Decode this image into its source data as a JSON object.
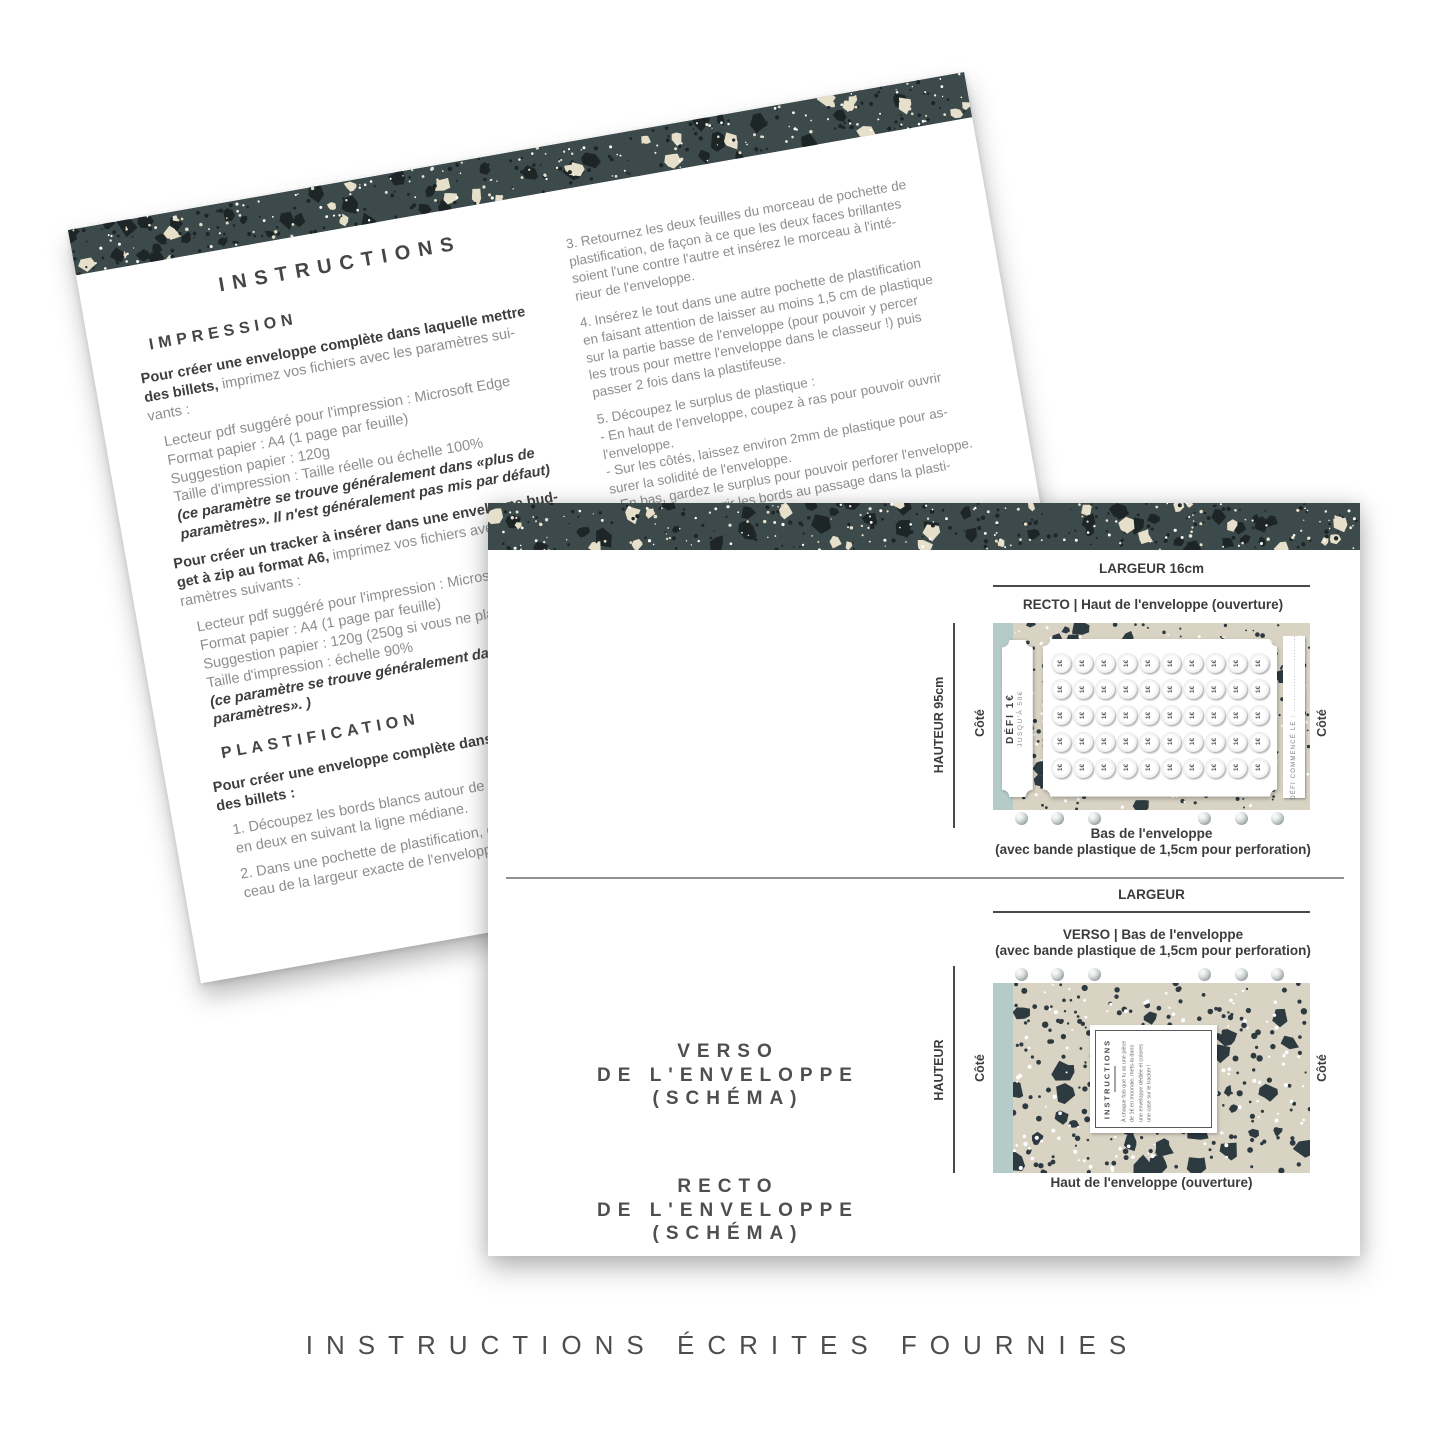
{
  "caption": "INSTRUCTIONS ÉCRITES FOURNIES",
  "colors": {
    "band_dark": "#3d4a4b",
    "band_chip_dark": "#1d2527",
    "band_chip_cream": "#e6dfca",
    "envelope_beige": "#d9d3c4",
    "envelope_chip": "#2d3a40",
    "sage_strip": "#b5cbc7",
    "text_dark": "#3e3e3e",
    "text_gray": "#8d8d8d"
  },
  "back_page": {
    "title": "INSTRUCTIONS",
    "left_column": [
      {
        "h": "IMPRESSION"
      },
      {
        "gap": 10
      },
      {
        "t": [
          [
            "b",
            "Pour créer une enveloppe complète dans laquelle mettre"
          ]
        ]
      },
      {
        "t": [
          [
            "b",
            "des billets, "
          ],
          [
            "r",
            "imprimez vos fichiers avec les paramètres sui-"
          ]
        ]
      },
      {
        "t": [
          [
            "r",
            "vants :"
          ]
        ]
      },
      {
        "gap": 9
      },
      {
        "t": [
          [
            "r",
            "Lecteur pdf suggéré pour l'impression : Microsoft Edge"
          ]
        ],
        "ind": 1
      },
      {
        "t": [
          [
            "r",
            "Format papier : A4 (1 page par feuille)"
          ]
        ],
        "ind": 1
      },
      {
        "t": [
          [
            "r",
            "Suggestion papier : 120g"
          ]
        ],
        "ind": 1
      },
      {
        "t": [
          [
            "r",
            "Taille d'impression : Taille réelle ou échelle 100%"
          ]
        ],
        "ind": 1
      },
      {
        "t": [
          [
            "bi",
            "(ce paramètre se trouve généralement dans «plus de"
          ]
        ],
        "ind": 1
      },
      {
        "t": [
          [
            "bi",
            "paramètres». Il n'est généralement pas mis par défaut)"
          ]
        ],
        "ind": 1
      },
      {
        "gap": 9
      },
      {
        "t": [
          [
            "b",
            "Pour créer un tracker à insérer dans une enveloppe bud-"
          ]
        ]
      },
      {
        "t": [
          [
            "b",
            "get à zip au format A6, "
          ],
          [
            "r",
            "imprimez vos fichiers avec les pa-"
          ]
        ]
      },
      {
        "t": [
          [
            "r",
            "ramètres suivants :"
          ]
        ]
      },
      {
        "gap": 9
      },
      {
        "t": [
          [
            "r",
            "Lecteur pdf suggéré pour l'impression : Microsoft Edge"
          ]
        ],
        "ind": 1
      },
      {
        "t": [
          [
            "r",
            "Format papier : A4 (1 page par feuille)"
          ]
        ],
        "ind": 1
      },
      {
        "t": [
          [
            "r",
            "Suggestion papier : 120g (250g si vous ne plastifiez pas)"
          ]
        ],
        "ind": 1
      },
      {
        "t": [
          [
            "r",
            "Taille d'impression : échelle 90%"
          ]
        ],
        "ind": 1
      },
      {
        "t": [
          [
            "bi",
            "(ce paramètre se trouve généralement dans «plus de"
          ]
        ],
        "ind": 1
      },
      {
        "t": [
          [
            "bi",
            "paramètres». )"
          ]
        ],
        "ind": 1
      },
      {
        "gap": 12
      },
      {
        "h": "PLASTIFICATION"
      },
      {
        "gap": 10
      },
      {
        "t": [
          [
            "b",
            "Pour créer une enveloppe complète dans laquelle mettre"
          ]
        ]
      },
      {
        "t": [
          [
            "b",
            "des billets :"
          ]
        ]
      },
      {
        "gap": 7
      },
      {
        "t": [
          [
            "r",
            "1. Découpez les bords blancs autour de vos feuilles et pliez"
          ]
        ],
        "ind": 1
      },
      {
        "t": [
          [
            "r",
            "en deux en suivant la ligne médiane."
          ]
        ],
        "ind": 1
      },
      {
        "gap": 7
      },
      {
        "t": [
          [
            "r",
            "2. Dans une pochette de plastification, découpez un mor-"
          ]
        ],
        "ind": 1
      },
      {
        "t": [
          [
            "r",
            "ceau de la largeur exacte de l'enveloppe."
          ]
        ],
        "ind": 1
      }
    ],
    "right_column": [
      {
        "t": [
          [
            "r",
            "3. Retournez les deux feuilles du morceau de pochette de"
          ]
        ]
      },
      {
        "t": [
          [
            "r",
            "plastification, de façon à ce que les deux faces brillantes"
          ]
        ]
      },
      {
        "t": [
          [
            "r",
            "soient l'une contre l'autre et insérez le morceau à l'inté-"
          ]
        ]
      },
      {
        "t": [
          [
            "r",
            "rieur de l'enveloppe."
          ]
        ]
      },
      {
        "gap": 10
      },
      {
        "t": [
          [
            "r",
            "4. Insérez le tout dans une autre pochette de plastification"
          ]
        ]
      },
      {
        "t": [
          [
            "r",
            "en faisant attention de laisser au moins 1,5 cm de plastique"
          ]
        ]
      },
      {
        "t": [
          [
            "r",
            "sur la partie basse de l'enveloppe (pour pouvoir y percer"
          ]
        ]
      },
      {
        "t": [
          [
            "r",
            "les trous pour mettre l'enveloppe dans le classeur !) puis"
          ]
        ]
      },
      {
        "t": [
          [
            "r",
            "passer 2 fois dans la plastifeuse."
          ]
        ]
      },
      {
        "gap": 10
      },
      {
        "t": [
          [
            "r",
            "5. Découpez le surplus de plastique :"
          ]
        ]
      },
      {
        "t": [
          [
            "r",
            "- En haut de l'enveloppe, coupez à ras pour pouvoir ouvrir"
          ]
        ]
      },
      {
        "t": [
          [
            "r",
            "l'enveloppe."
          ]
        ]
      },
      {
        "t": [
          [
            "r",
            "- Sur les côtés, laissez environ 2mm de plastique pour as-"
          ]
        ]
      },
      {
        "t": [
          [
            "r",
            "surer la solidité de l'enveloppe."
          ]
        ]
      },
      {
        "t": [
          [
            "r",
            "- En bas, gardez le surplus pour pouvoir perforer l'enveloppe."
          ]
        ]
      },
      {
        "t": [
          [
            "r",
            "sans risquer d'ouvrir les bords au passage dans la plasti-"
          ]
        ]
      },
      {
        "t": [
          [
            "r",
            "fieuse."
          ]
        ]
      }
    ]
  },
  "front_page": {
    "recto": {
      "heading_lines": [
        "RECTO",
        "DE L'ENVELOPPE",
        "(SCHÉMA)"
      ],
      "width_label": "LARGEUR 16cm",
      "top_label": "RECTO | Haut de l'enveloppe (ouverture)",
      "bottom_label_1": "Bas de l'enveloppe",
      "bottom_label_2": "(avec bande plastique de 1,5cm pour perforation)",
      "height_label": "HAUTEUR 95cm",
      "side_label_left": "Côté",
      "side_label_right": "Côté",
      "plaque_title": "DÉFI 1€",
      "plaque_subtitle": "JUSQU'À 50€",
      "right_plaque_text": "DÉFI COMMENCÉ LE : ...........................",
      "coin_label": "1€",
      "coin_rows": 5,
      "coin_cols": 10
    },
    "verso": {
      "heading_lines": [
        "VERSO",
        "DE L'ENVELOPPE",
        "(SCHÉMA)"
      ],
      "width_label": "LARGEUR",
      "top_label_1": "VERSO | Bas de l'enveloppe",
      "top_label_2": "(avec bande plastique de 1,5cm pour perforation)",
      "bottom_label": "Haut de l'enveloppe (ouverture)",
      "height_label": "HAUTEUR",
      "side_label_left": "Côté",
      "side_label_right": "Côté",
      "card_title": "INSTRUCTIONS",
      "card_text": "À chaque fois que tu as une pièce de 1€ en monnaie, mets-la dans une enveloppe dédiée et colores une case sur le tracker !"
    },
    "hole_offsets": [
      22,
      58,
      95,
      205,
      242,
      278
    ]
  }
}
